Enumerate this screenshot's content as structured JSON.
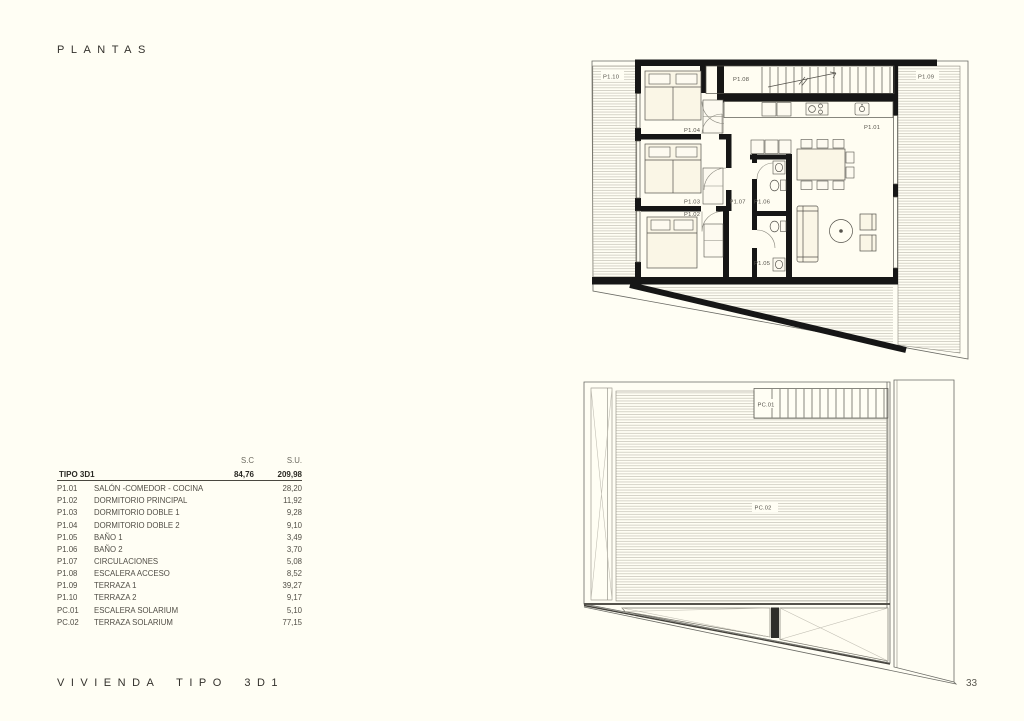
{
  "page": {
    "title": "PLANTAS",
    "footer_title": "VIVIENDA TIPO 3D1",
    "page_number": "33",
    "background_color": "#FFFEF4"
  },
  "area_table": {
    "columns": {
      "sc": "S.C",
      "su": "S.U."
    },
    "total": {
      "name": "TIPO 3D1",
      "sc": "84,76",
      "su": "209,98"
    },
    "rows": [
      {
        "code": "P1.01",
        "name": "SALÓN -COMEDOR - COCINA",
        "su": "28,20"
      },
      {
        "code": "P1.02",
        "name": "DORMITORIO PRINCIPAL",
        "su": "11,92"
      },
      {
        "code": "P1.03",
        "name": "DORMITORIO DOBLE 1",
        "su": "9,28"
      },
      {
        "code": "P1.04",
        "name": "DORMITORIO DOBLE 2",
        "su": "9,10"
      },
      {
        "code": "P1.05",
        "name": "BAÑO 1",
        "su": "3,49"
      },
      {
        "code": "P1.06",
        "name": "BAÑO 2",
        "su": "3,70"
      },
      {
        "code": "P1.07",
        "name": "CIRCULACIONES",
        "su": "5,08"
      },
      {
        "code": "P1.08",
        "name": "ESCALERA ACCESO",
        "su": "8,52"
      },
      {
        "code": "P1.09",
        "name": "TERRAZA 1",
        "su": "39,27"
      },
      {
        "code": "P1.10",
        "name": "TERRAZA 2",
        "su": "9,17"
      },
      {
        "code": "PC.01",
        "name": "ESCALERA SOLARIUM",
        "su": "5,10"
      },
      {
        "code": "PC.02",
        "name": "TERRAZA SOLARIUM",
        "su": "77,15"
      }
    ]
  },
  "floor_plan": {
    "labels": {
      "p101": "P1.01",
      "p102": "P1.02",
      "p103": "P1.03",
      "p104": "P1.04",
      "p105": "P1.05",
      "p106": "P1.06",
      "p107": "P1.07",
      "p108": "P1.08",
      "p109": "P1.09",
      "p110": "P1.10"
    }
  },
  "roof_plan": {
    "labels": {
      "pc01": "PC.01",
      "pc02": "PC.02"
    }
  }
}
